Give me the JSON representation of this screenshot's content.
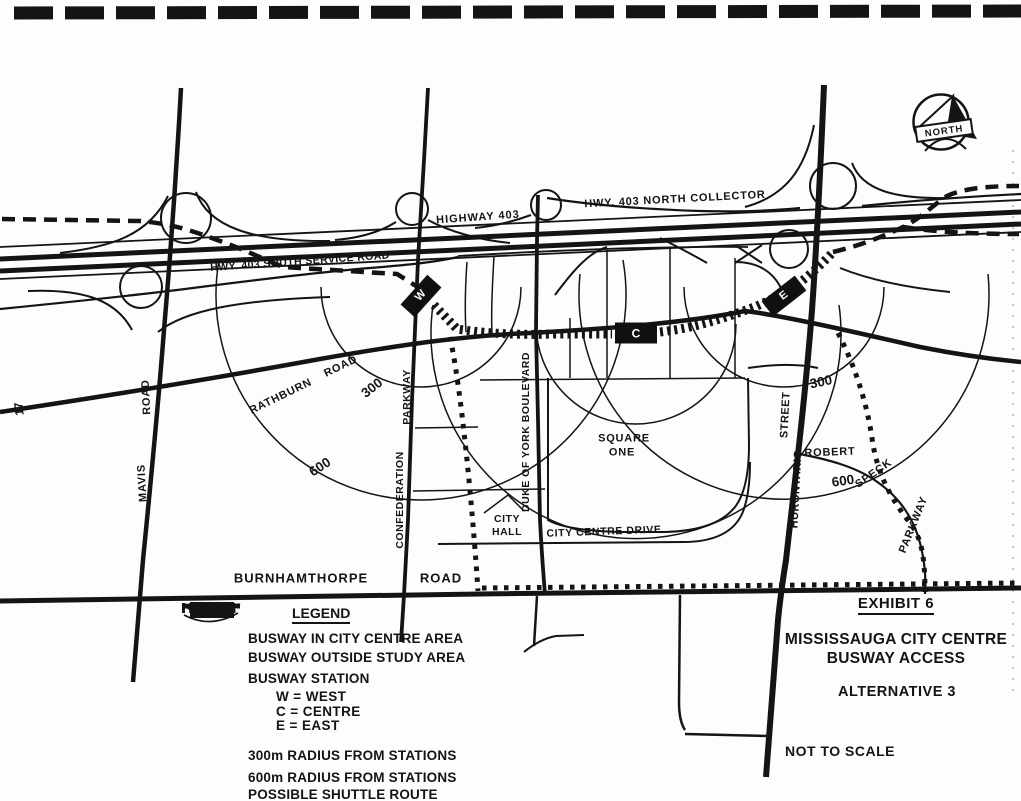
{
  "page": {
    "number": "17"
  },
  "north": {
    "label": "NORTH"
  },
  "map": {
    "highway_labels": {
      "main": "HIGHWAY 403",
      "north_collector": "HWY. 403 NORTH COLLECTOR",
      "south_service": "HWY. 403 SOUTH SERVICE ROAD"
    },
    "road_labels": {
      "mavis_name": "MAVIS",
      "mavis_type": "ROAD",
      "rathburn_name": "RATHBURN",
      "rathburn_type": "ROAD",
      "confederation_name": "CONFEDERATION",
      "confederation_type": "PARKWAY",
      "duke_of_york": "DUKE OF YORK BOULEVARD",
      "hurontario_name": "HURONTARIO",
      "hurontario_type": "STREET",
      "burnhamthorpe_name": "BURNHAMTHORPE",
      "burnhamthorpe_type": "ROAD",
      "city_centre_drive": "CITY CENTRE DRIVE",
      "robert": "ROBERT",
      "speck": "SPECK",
      "speck_type": "PARKWAY"
    },
    "place_labels": {
      "square_one_line1": "SQUARE",
      "square_one_line2": "ONE",
      "city_hall_line1": "CITY",
      "city_hall_line2": "HALL"
    },
    "radius_labels": {
      "w300": "300",
      "w600": "600",
      "e300": "300",
      "e600": "600"
    },
    "stations": {
      "west": "W",
      "centre": "C",
      "east": "E"
    }
  },
  "legend": {
    "title": "LEGEND",
    "items": [
      {
        "symbol": "busway-city-centre",
        "label": "BUSWAY IN CITY CENTRE AREA"
      },
      {
        "symbol": "busway-outside-study",
        "label": "BUSWAY OUTSIDE STUDY AREA"
      },
      {
        "symbol": "busway-station",
        "label": "BUSWAY STATION"
      },
      {
        "symbol": "station-code",
        "label": "W = WEST"
      },
      {
        "symbol": "station-code",
        "label": "C = CENTRE"
      },
      {
        "symbol": "station-code",
        "label": "E = EAST"
      },
      {
        "symbol": "radius-300",
        "label": "300m RADIUS FROM STATIONS"
      },
      {
        "symbol": "radius-600",
        "label": "600m RADIUS FROM STATIONS"
      },
      {
        "symbol": "shuttle-route",
        "label": "POSSIBLE SHUTTLE ROUTE"
      }
    ]
  },
  "title_block": {
    "exhibit": "EXHIBIT 6",
    "line1": "MISSISSAUGA CITY CENTRE",
    "line2": "BUSWAY ACCESS",
    "alternative": "ALTERNATIVE 3",
    "note": "NOT TO SCALE"
  },
  "colors": {
    "ink": "#141414",
    "paper": "#fdfdfc"
  }
}
